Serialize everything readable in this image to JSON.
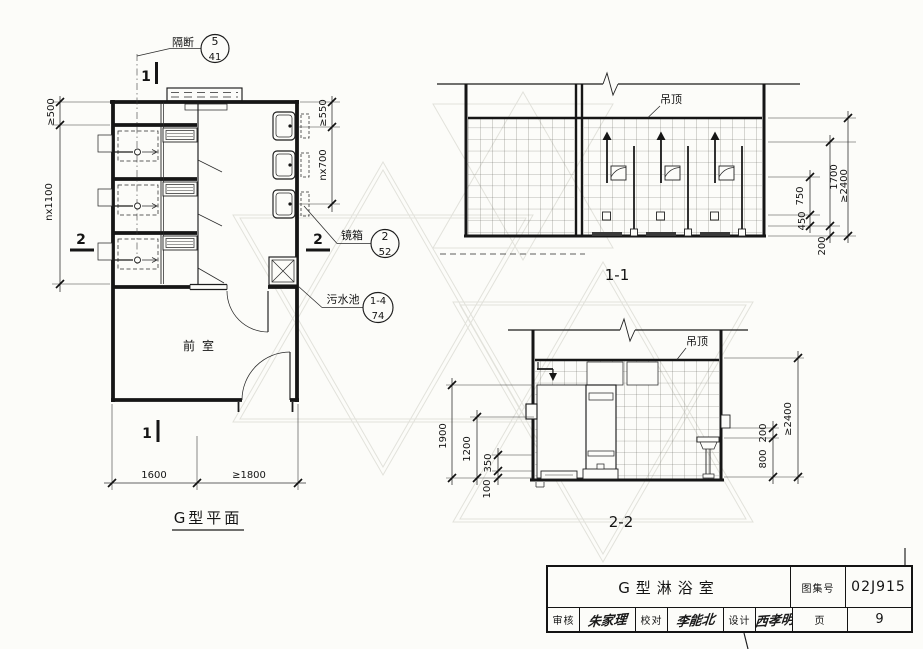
{
  "plan": {
    "title": "G型平面",
    "room": "前室",
    "marker1": "1",
    "marker2": "2",
    "note_partition": {
      "label": "隔断",
      "num": "5",
      "den": "41"
    },
    "note_mirror": {
      "label": "镜箱",
      "num": "2",
      "den": "52"
    },
    "note_sink": {
      "label": "污水池",
      "num": "1-4",
      "den": "74"
    },
    "dim_left_top": "≥500",
    "dim_left_main": "nx1100",
    "dim_right_top": "≥550",
    "dim_right_main": "nx700",
    "dim_bottom_1": "1600",
    "dim_bottom_2": "≥1800"
  },
  "s11": {
    "title": "1-1",
    "ceiling": "吊顶",
    "d200": "200",
    "d450": "450",
    "d750": "750",
    "d1700": "1700",
    "dtotal": "≥2400"
  },
  "s22": {
    "title": "2-2",
    "ceiling": "吊顶",
    "d1900": "1900",
    "d1200": "1200",
    "d350": "350",
    "d100": "100",
    "d200": "200",
    "d800": "800",
    "dtotal": "≥2400"
  },
  "titleblock": {
    "drawing_title": "G型淋浴室",
    "atlas_label": "图集号",
    "atlas_no": "02J915",
    "page_label": "页",
    "page_no": "9",
    "audit_label": "审核",
    "audit_sig": "朱家理",
    "check_label": "校对",
    "check_sig": "李能北",
    "design_label": "设计",
    "design_sig": "西孝明"
  }
}
